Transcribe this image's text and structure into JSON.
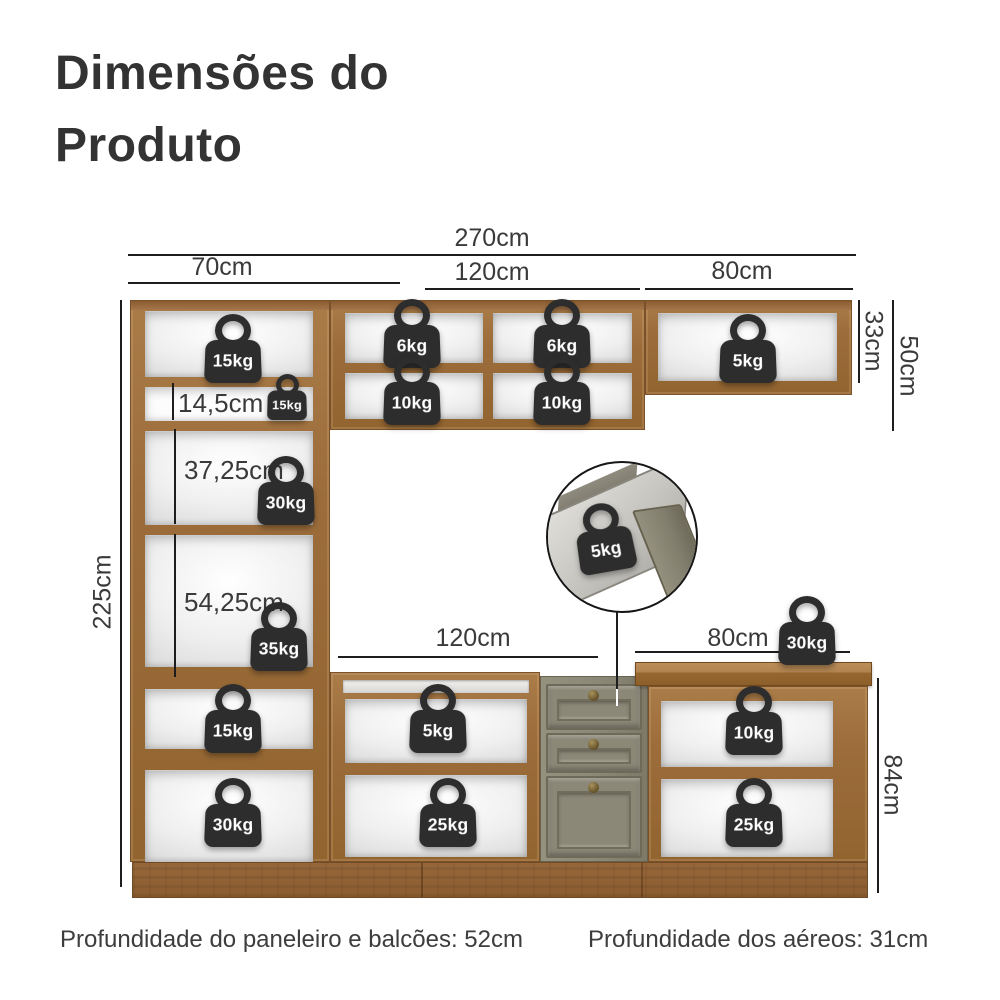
{
  "title": {
    "line1": "Dimensões do",
    "line2": "Produto"
  },
  "dimensions": {
    "total_width": "270cm",
    "paneleiro_width": "70cm",
    "aereo_center_width": "120cm",
    "aereo_right_width": "80cm",
    "aereo_right_height": "33cm",
    "aereo_height": "50cm",
    "paneleiro_height": "225cm",
    "nicho_small": "14,5cm",
    "nicho_medium": "37,25cm",
    "nicho_large": "54,25cm",
    "balcao_center_width": "120cm",
    "balcao_right_width": "80cm",
    "balcao_height": "84cm"
  },
  "weights": {
    "paneleiro_top": "15kg",
    "paneleiro_small_shelf": "15kg",
    "paneleiro_mid": "30kg",
    "paneleiro_lower": "35kg",
    "paneleiro_base_top": "15kg",
    "paneleiro_base_bottom": "30kg",
    "aereo_center_top_left": "6kg",
    "aereo_center_top_right": "6kg",
    "aereo_center_bottom_left": "10kg",
    "aereo_center_bottom_right": "10kg",
    "aereo_right": "5kg",
    "drawer_inset": "5kg",
    "countertop": "30kg",
    "balcao_center_top": "5kg",
    "balcao_center_bottom": "25kg",
    "balcao_right_top": "10kg",
    "balcao_right_bottom": "25kg"
  },
  "footer": {
    "left": "Profundidade do paneleiro e balcões: 52cm",
    "right": "Profundidade dos aéreos: 31cm"
  },
  "colors": {
    "wood": "#9c6d3b",
    "drawer_gray": "#8c8878",
    "weight_badge": "#2d2d2d",
    "text": "#3a3a3a",
    "background": "#ffffff"
  }
}
